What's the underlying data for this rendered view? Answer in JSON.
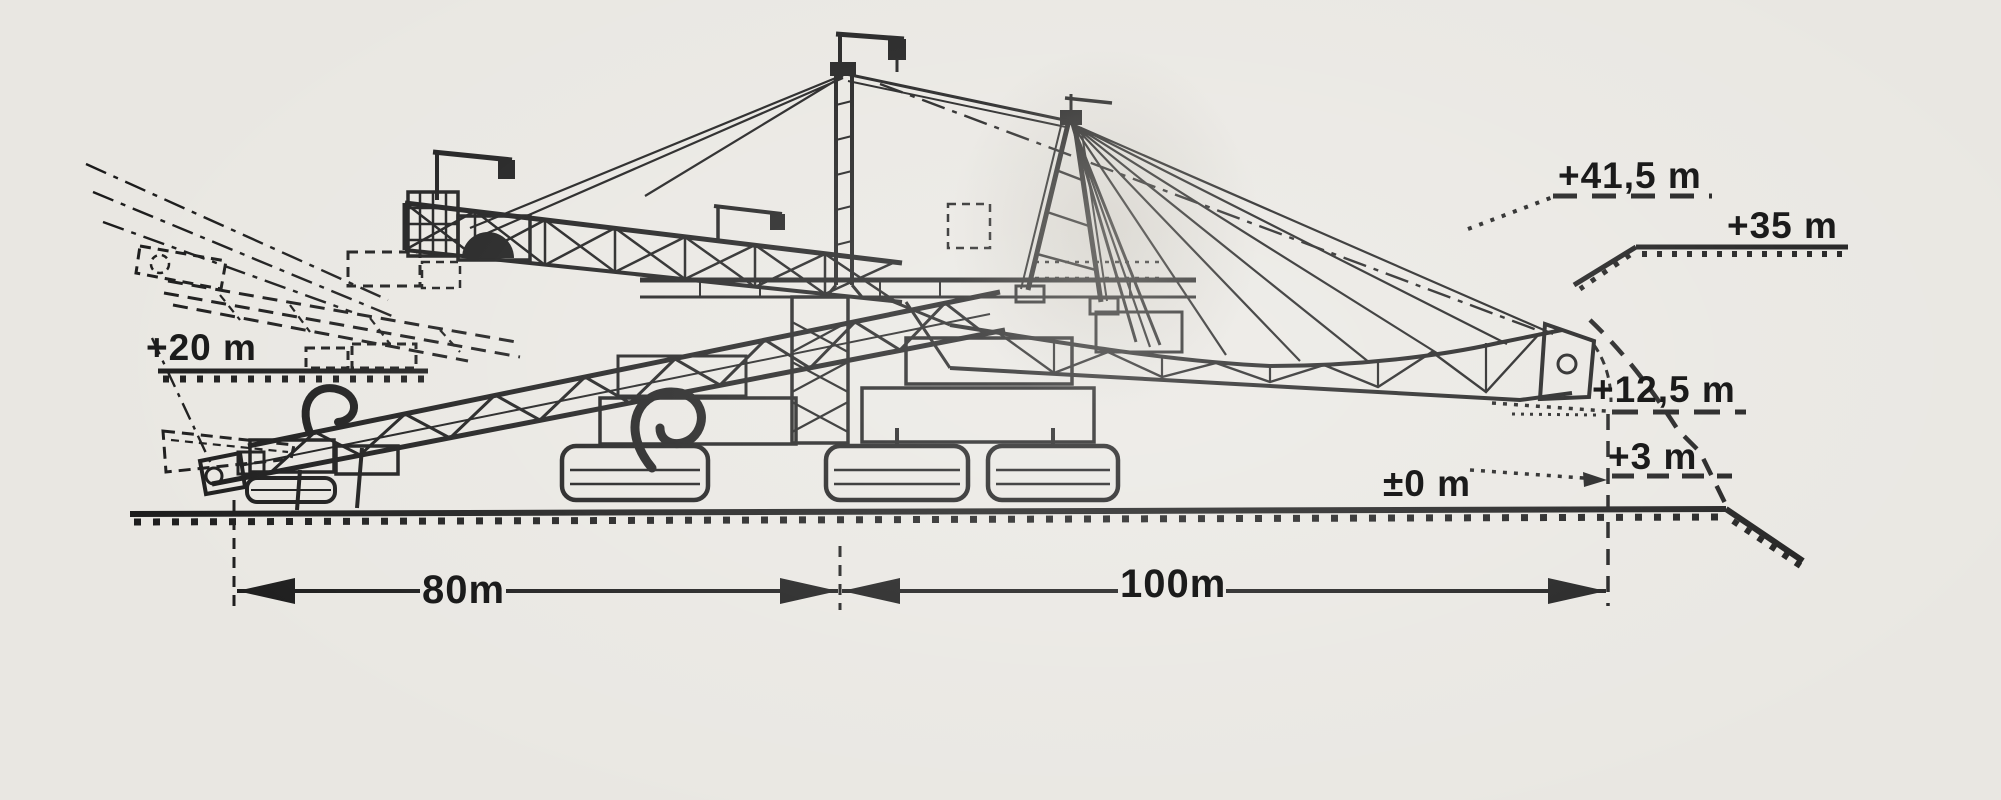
{
  "colors": {
    "paper": "#e9e7e2",
    "ink": "#1b1b1b"
  },
  "labels": {
    "e41_5": "+41,5 m",
    "e35": "+35 m",
    "e20": "+20 m",
    "e12_5": "+12,5 m",
    "e3": "+3 m",
    "e0": "±0 m",
    "d80": "80m",
    "d100": "100m"
  },
  "measurements": {
    "elevations_m": [
      41.5,
      35,
      20,
      12.5,
      3,
      0
    ],
    "left_span_m": 80,
    "right_span_m": 100
  }
}
